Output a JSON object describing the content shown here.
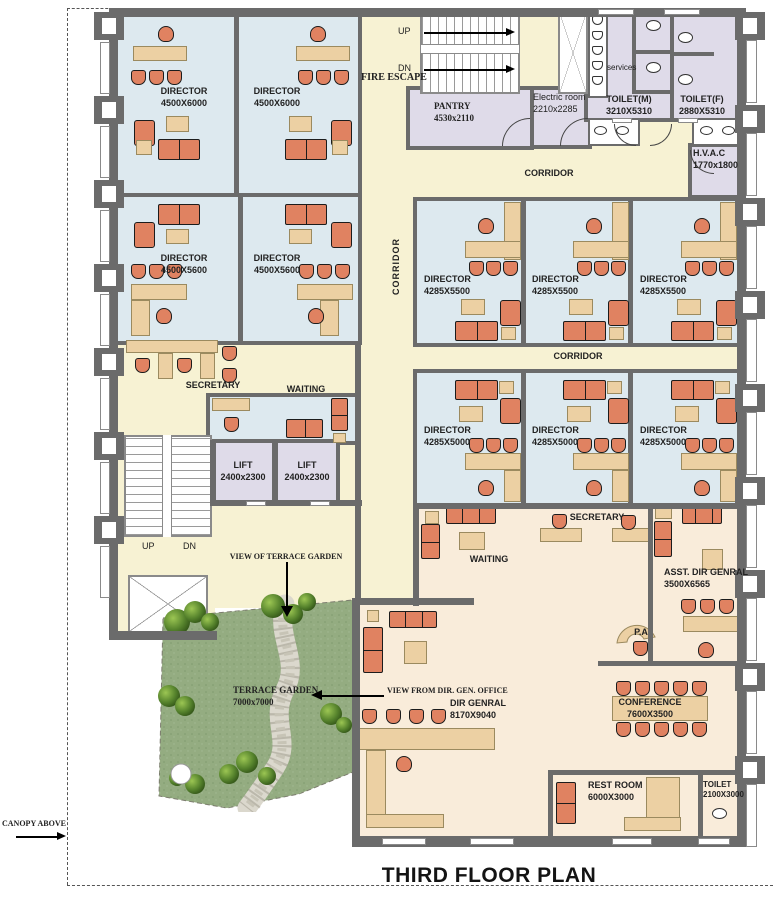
{
  "title": "THIRD FLOOR PLAN",
  "palette": {
    "corridor": "#f7f2d3",
    "office": "#dde9ef",
    "service": "#dfdbe9",
    "executive": "#f9ecda",
    "wall": "#6b6b6b",
    "furniture": "#e08261",
    "wood": "#ecd0a3",
    "garden": "#94ac81"
  },
  "annotations": {
    "canopy": "CANOPY ABOVE",
    "view_terrace": "VIEW OF TERRACE GARDEN",
    "view_dirgen": "VIEW FROM DIR. GEN. OFFICE",
    "fire_escape": "FIRE ESCAPE",
    "corridor": "CORRIDOR",
    "up": "UP",
    "dn": "DN"
  },
  "rooms": {
    "director_a1": {
      "name": "DIRECTOR",
      "dims": "4500X6000"
    },
    "director_a2": {
      "name": "DIRECTOR",
      "dims": "4500X6000"
    },
    "director_b1": {
      "name": "DIRECTOR",
      "dims": "4500X5600"
    },
    "director_b2": {
      "name": "DIRECTOR",
      "dims": "4500X5600"
    },
    "director_c1": {
      "name": "DIRECTOR",
      "dims": "4285X5500"
    },
    "director_c2": {
      "name": "DIRECTOR",
      "dims": "4285X5500"
    },
    "director_c3": {
      "name": "DIRECTOR",
      "dims": "4285X5500"
    },
    "director_d1": {
      "name": "DIRECTOR",
      "dims": "4285X5000"
    },
    "director_d2": {
      "name": "DIRECTOR",
      "dims": "4285X5000"
    },
    "director_d3": {
      "name": "DIRECTOR",
      "dims": "4285X5000"
    },
    "pantry": {
      "name": "PANTRY",
      "dims": "4530x2110"
    },
    "electric_room": {
      "name": "Electric room",
      "dims": "2210x2285"
    },
    "services": {
      "name": "services"
    },
    "toilet_m": {
      "name": "TOILET(M)",
      "dims": "3210X5310"
    },
    "toilet_f": {
      "name": "TOILET(F)",
      "dims": "2880X5310"
    },
    "hvac": {
      "name": "H.V.A.C",
      "dims": "1770x1800"
    },
    "secretary_upper": {
      "name": "SECRETARY"
    },
    "waiting_upper": {
      "name": "WAITING"
    },
    "lift_1": {
      "name": "LIFT",
      "dims": "2400x2300"
    },
    "lift_2": {
      "name": "LIFT",
      "dims": "2400x2300"
    },
    "terrace_garden": {
      "name": "TERRACE GARDEN",
      "dims": "7000x7000"
    },
    "dir_genral": {
      "name": "DIR GENRAL",
      "dims": "8170X9040"
    },
    "waiting_lower": {
      "name": "WAITING"
    },
    "secretary_lower": {
      "name": "SECRETARY"
    },
    "asst_dir_genral": {
      "name": "ASST. DIR GENRAL",
      "dims": "3500X6565"
    },
    "pa": {
      "name": "P.A"
    },
    "conference": {
      "name": "CONFERENCE",
      "dims": "7600X3500"
    },
    "rest_room": {
      "name": "REST ROOM",
      "dims": "6000X3000"
    },
    "toilet_small": {
      "name": "TOILET",
      "dims": "2100X3000"
    }
  }
}
